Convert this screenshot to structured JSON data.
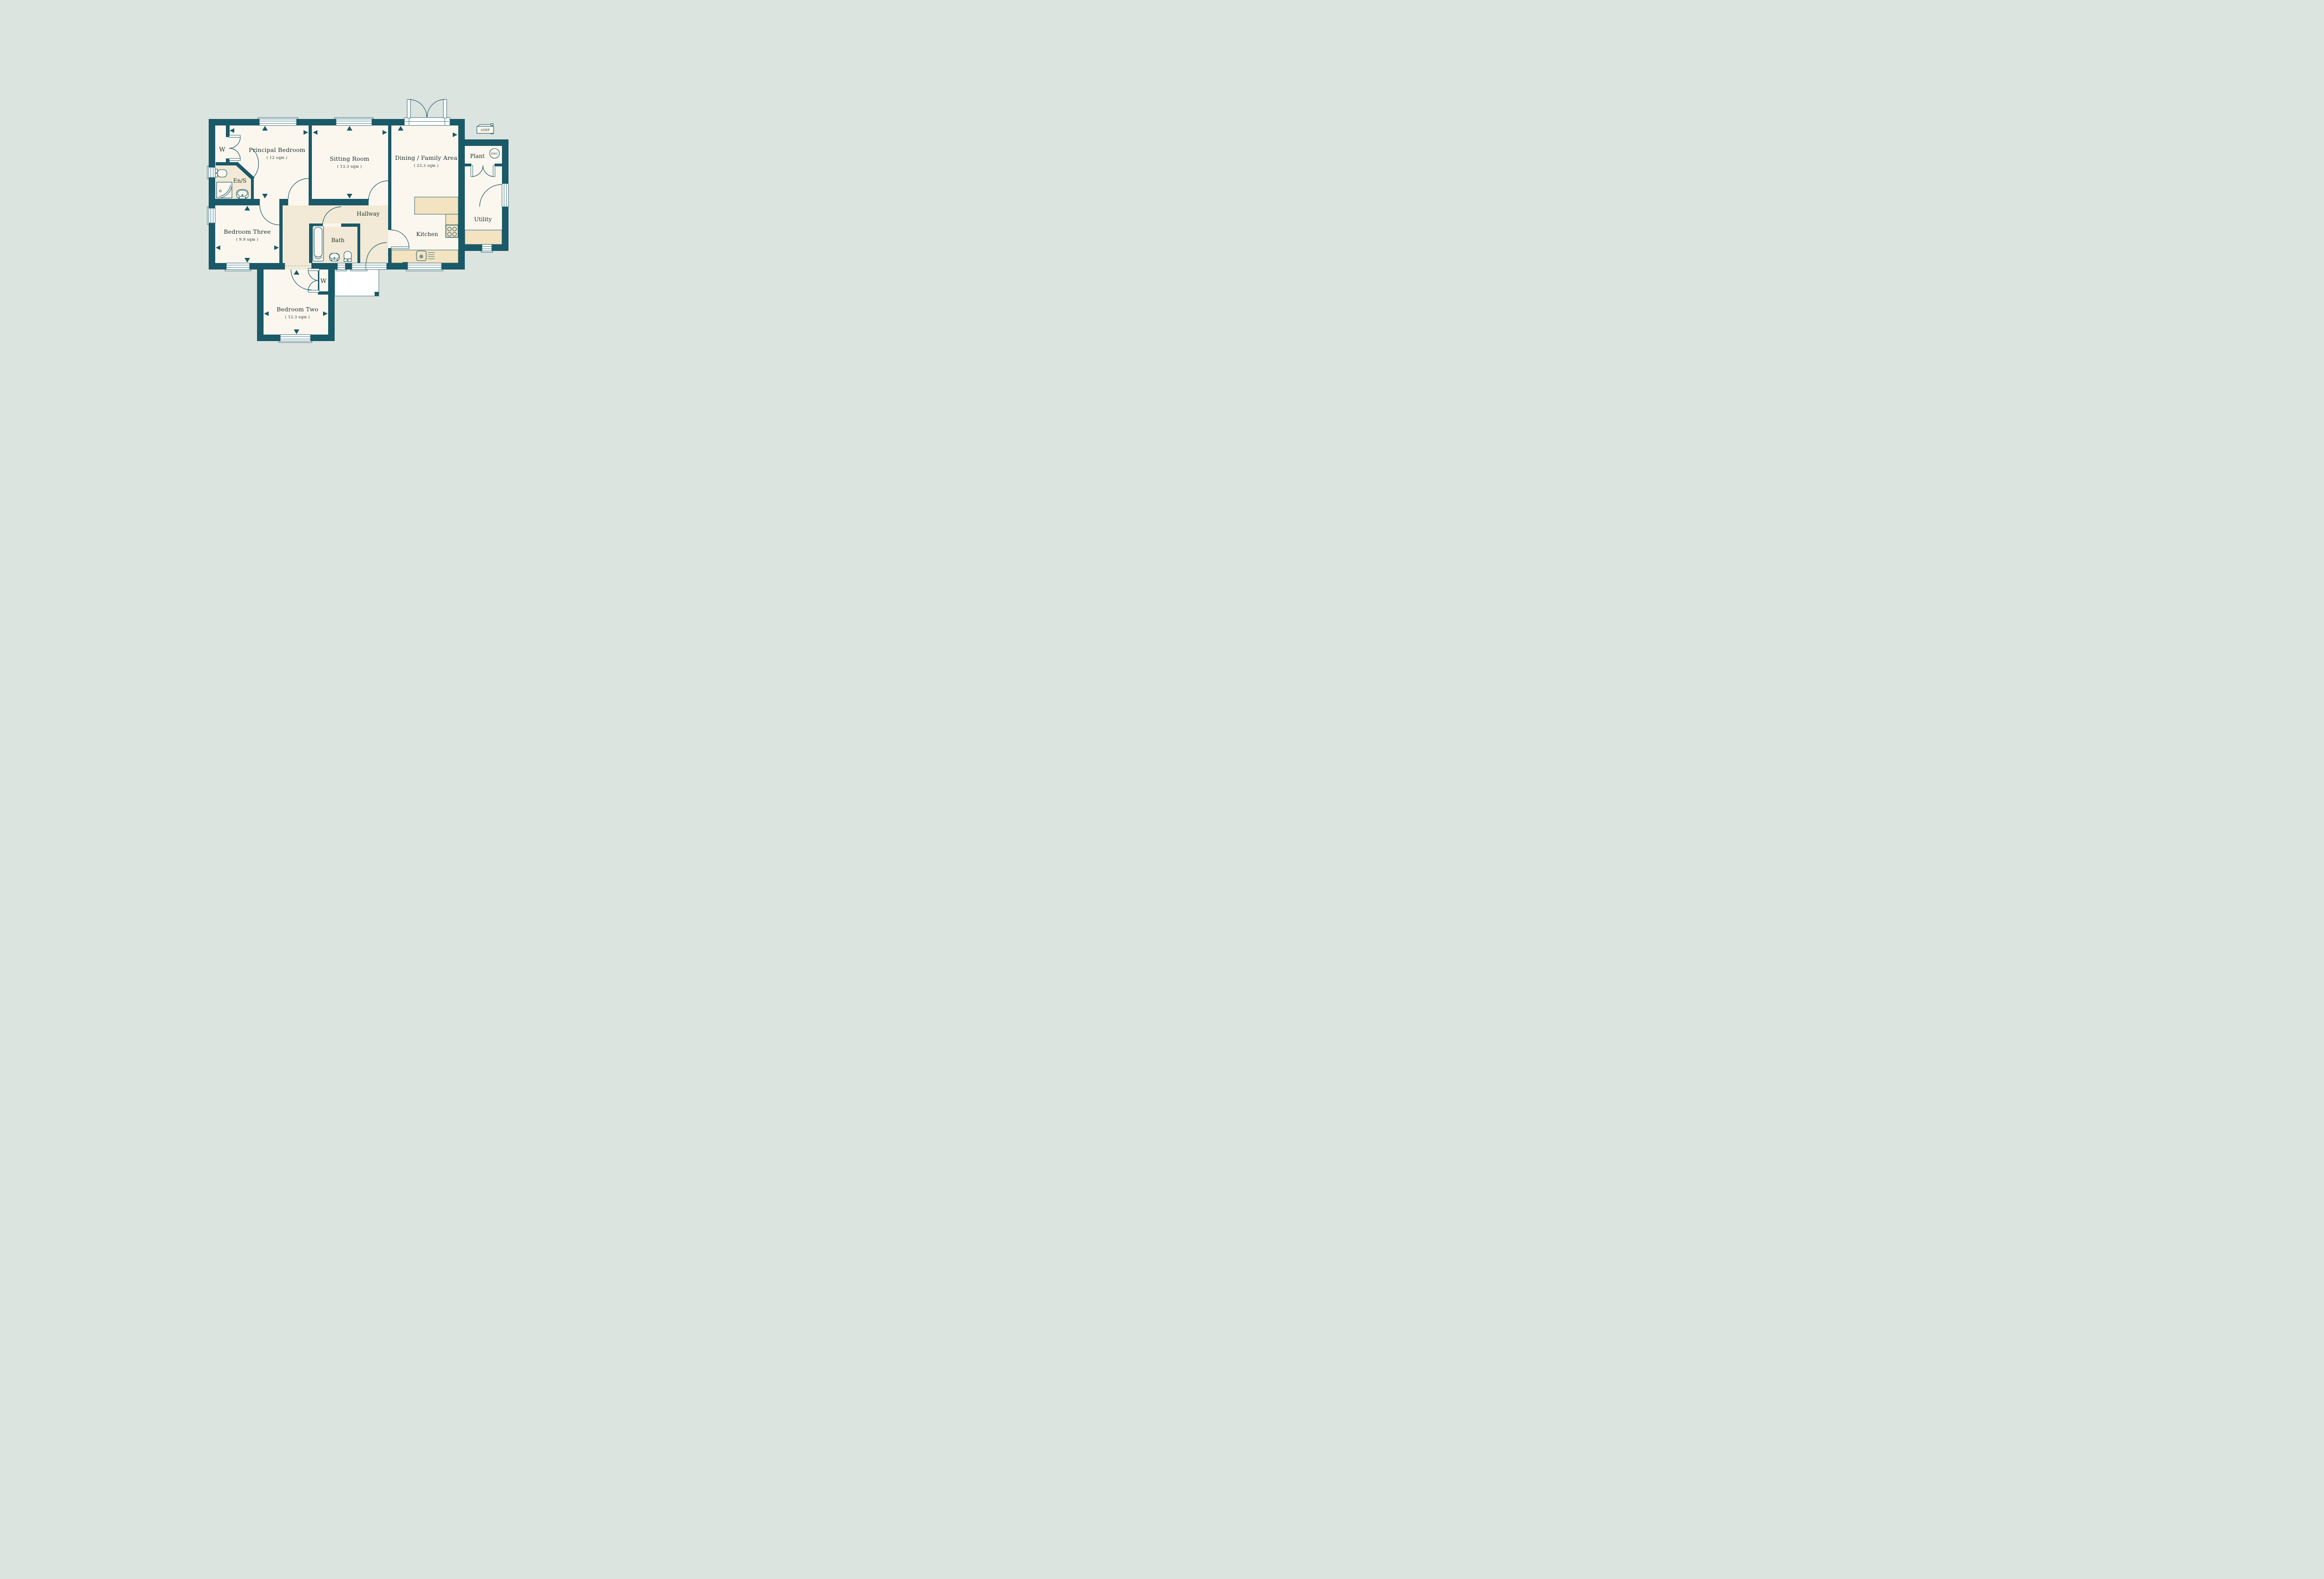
{
  "palette": {
    "bg": "#dce4e0",
    "wall": "#1a5968",
    "room": "#fbf7ef",
    "zone": "#f2ead6",
    "counter": "#f3e3c0",
    "text": "#20342b",
    "dash": "#a9bcc0"
  },
  "floorplan": {
    "rooms": {
      "principal_bedroom": {
        "name": "Principal Bedroom",
        "area": "( 12 sqm )"
      },
      "sitting_room": {
        "name": "Sitting Room",
        "area": "( 13.3 sqm )"
      },
      "dining_family_area": {
        "name": "Dining / Family Area",
        "area": "( 23.3 sqm )"
      },
      "bedroom_three": {
        "name": "Bedroom Three",
        "area": "( 9.9 sqm )"
      },
      "bedroom_two": {
        "name": "Bedroom Two",
        "area": "( 12.3 sqm )"
      },
      "hallway": {
        "name": "Hallway"
      },
      "bath": {
        "name": "Bath"
      },
      "kitchen": {
        "name": "Kitchen"
      },
      "ensuite": {
        "name": "En/S"
      },
      "utility": {
        "name": "Utility"
      },
      "plant": {
        "name": "Plant"
      },
      "principal_wardrobe": {
        "name": "W"
      },
      "bedroom_two_wardrobe": {
        "name": "W"
      }
    },
    "equipment": {
      "ashp_label": "ASHP",
      "hwc_label": "HWC"
    }
  }
}
